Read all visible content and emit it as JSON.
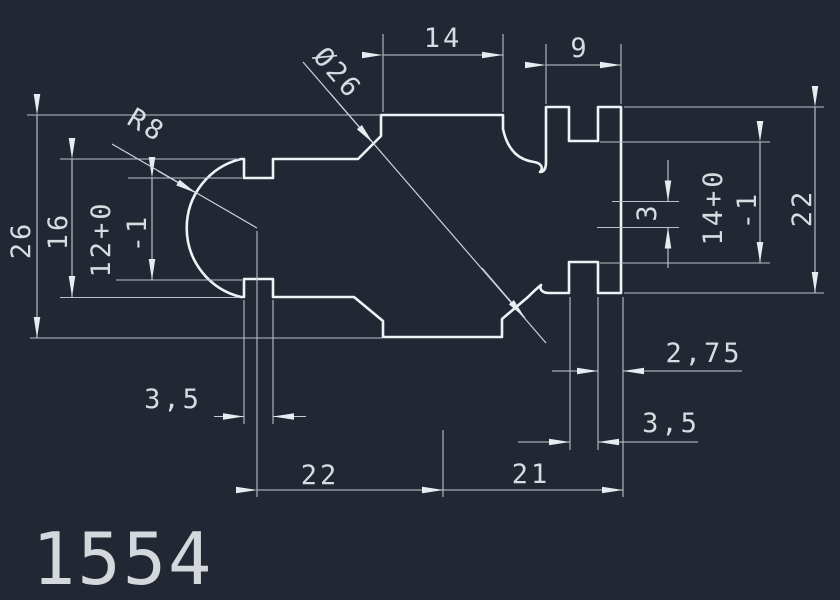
{
  "drawing": {
    "part_number": "1554",
    "colors": {
      "background": "#212733",
      "outline": "#f0f3f6",
      "dimension_lines": "#c6ccd6",
      "text": "#d8dce1"
    },
    "dimensions": {
      "top_width": "14",
      "top_right_width": "9",
      "diameter_note": "Ø26",
      "radius_note": "R8",
      "left_overall": "26",
      "left_section_height": "16",
      "left_tolerance": {
        "line1": "12+0",
        "line2": "-1"
      },
      "right_center_offset": "3",
      "right_tolerance": {
        "line1": "14+0",
        "line2": "-1"
      },
      "right_overall": "22",
      "left_slot_width": "3,5",
      "right_slot_width": "3,5",
      "right_edge_offset": "2,75",
      "bottom_left_span": "22",
      "bottom_right_span": "21"
    }
  }
}
